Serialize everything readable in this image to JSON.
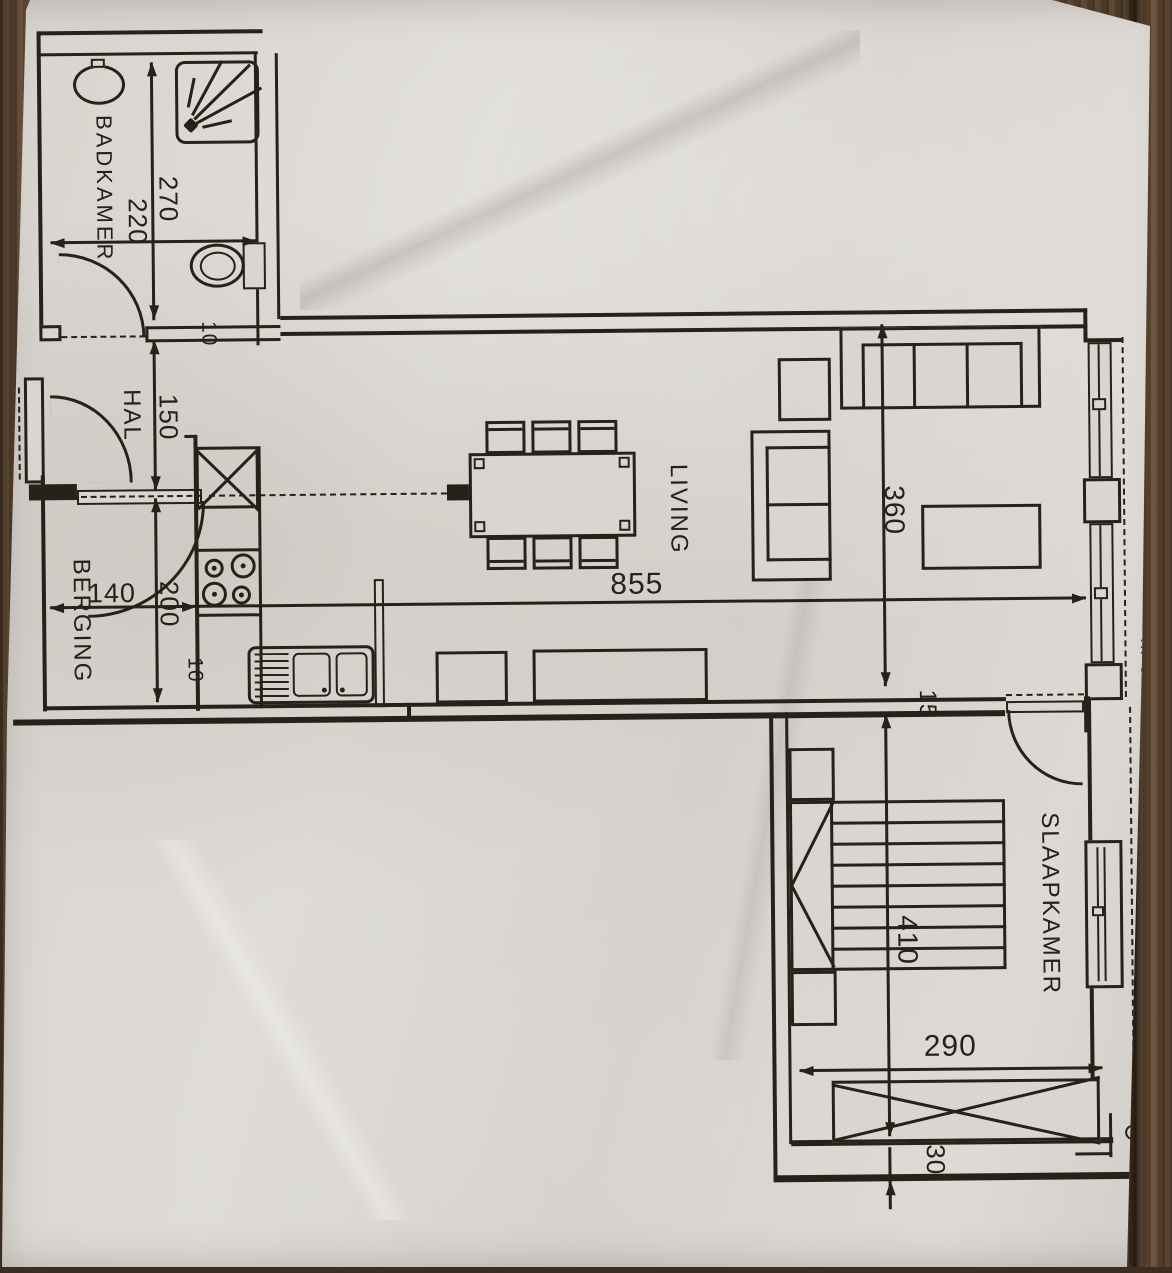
{
  "plan": {
    "rooms": {
      "badkamer": "BADKAMER",
      "hal": "HAL",
      "berging": "BERGING",
      "living": "LIVING",
      "slaapkamer": "SLAAPKAMER"
    },
    "dims": {
      "bad_h": "270",
      "bad_w": "220",
      "bad_wall": "10",
      "hal_h": "150",
      "berging_h": "200",
      "berging_w": "140",
      "kitchen_wall": "10",
      "living_w": "855",
      "living_h": "360",
      "partition": "15",
      "bed_h": "410",
      "bed_w": "290",
      "ledge": "30"
    },
    "note": "nr 0.5",
    "colors": {
      "ink": "#262119",
      "paper": "#d9d6d1",
      "wood": "#5e4936"
    }
  }
}
